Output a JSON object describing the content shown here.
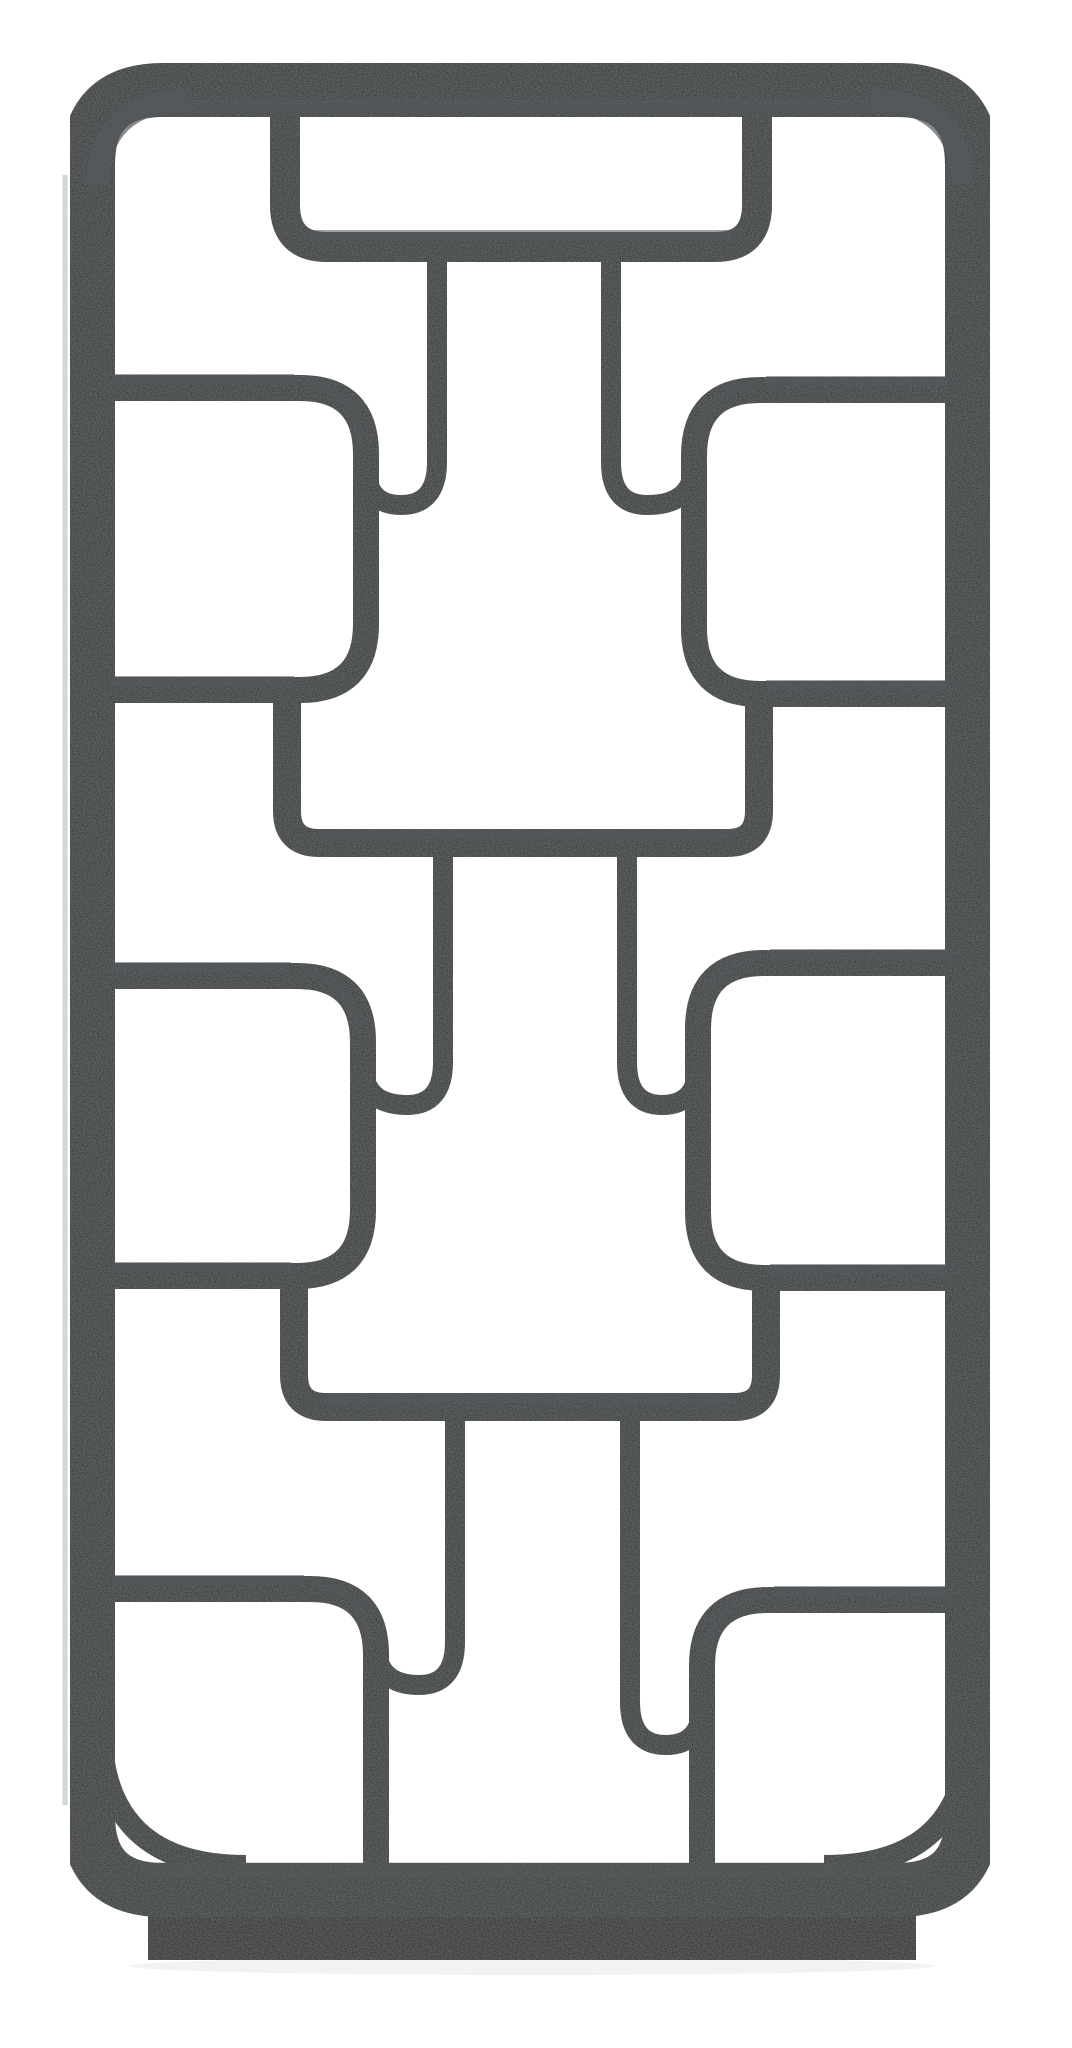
{
  "image": {
    "description": "Product photograph of a tall black wooden open-frame display bookshelf (etagere / room-divider curio) with an asymmetric geometric lattice of rounded-corner compartments and S-curved dividers, standing on a recessed plinth base against a plain white background",
    "style": "Chinese-inspired geometric open shelving, charcoal-black distressed mango wood finish",
    "orientation": "portrait"
  },
  "colors": {
    "background": "#ffffff",
    "wood": "#232528",
    "wood_deep": "#17191b",
    "wood_highlight": "#565a5c",
    "plinth": "#141517",
    "shadow": "#000000"
  },
  "structure": {
    "outer_frame": "rounded rectangle frame",
    "hanging_top_tray": 1,
    "side_compartments": 6,
    "bridge_shelves": 2,
    "s_curve_dividers": 6,
    "corner_brackets": 2,
    "base": "recessed plinth block"
  }
}
